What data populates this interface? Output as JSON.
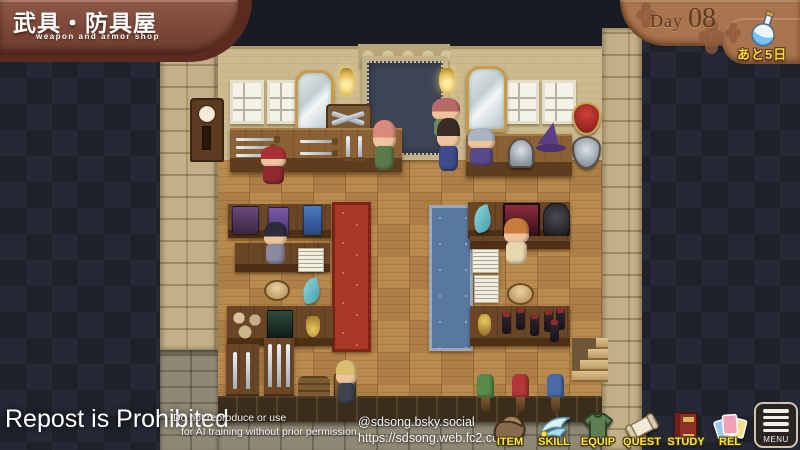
{
  "header": {
    "shop_title_jp": "武具・防具屋",
    "shop_title_en": "weapon and armor shop"
  },
  "day_banner": {
    "label": "Day",
    "number": "08"
  },
  "countdown_badge": {
    "text": "あと5日",
    "icon": "flask-icon"
  },
  "watermark": {
    "title": "Repost is Prohibited",
    "line1": "Do not reproduce or use",
    "line2": "for AI training without prior permission."
  },
  "credits": {
    "bsky": "@sdsong.bsky.social",
    "url": "https://sdsong.web.fc2.com/"
  },
  "menu": {
    "items": [
      {
        "id": "item",
        "label": "ITEM",
        "icon": "bag-icon"
      },
      {
        "id": "skill",
        "label": "SKILL",
        "icon": "wing-icon"
      },
      {
        "id": "equip",
        "label": "EQUIP",
        "icon": "tunic-icon"
      },
      {
        "id": "quest",
        "label": "QUEST",
        "icon": "scroll-icon"
      },
      {
        "id": "study",
        "label": "STUDY",
        "icon": "book-icon"
      },
      {
        "id": "rel",
        "label": "REL",
        "icon": "cards-icon"
      }
    ],
    "menu_button": {
      "label": "MENU",
      "icon": "hamburger-icon"
    }
  },
  "colors": {
    "banner_brown": "#7d4a38",
    "plaque_brown": "#a9744e",
    "badge_yellow": "#ffd832",
    "label_yellow": "#ffe53e",
    "bg_dark": "#1e202a",
    "wall_tan": "#cbba8e",
    "floor_wood": "#b98a4e",
    "carpet_red": "#a83828",
    "carpet_blue": "#5878a0"
  }
}
